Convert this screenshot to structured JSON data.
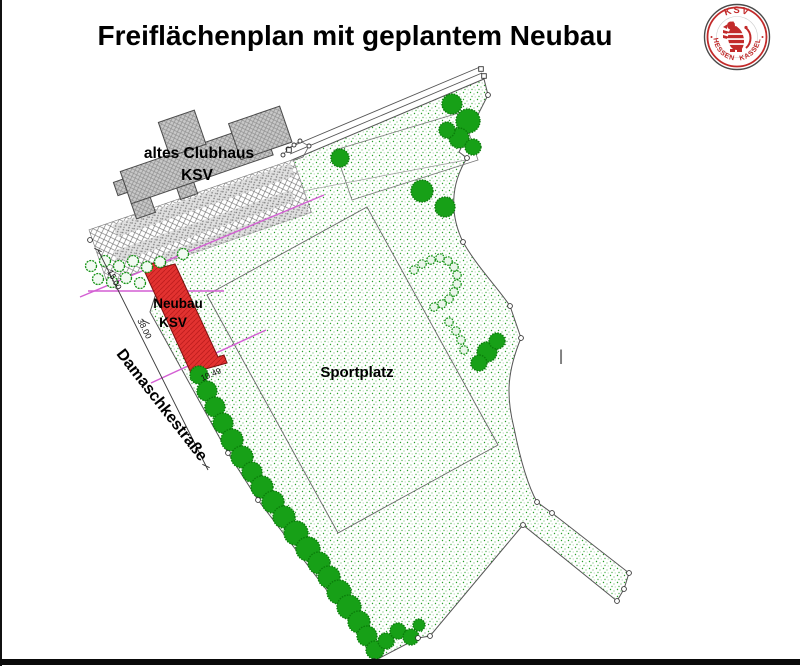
{
  "page": {
    "title": "Freiflächenplan mit geplantem Neubau"
  },
  "logo": {
    "arc_top": "KSV",
    "arc_bottom_left": "HESSEN",
    "arc_bottom_right": "KASSEL",
    "red": "#c22a2a"
  },
  "plan": {
    "buildings": {
      "clubhouse": {
        "line1": "altes Clubhaus",
        "line2": "KSV"
      },
      "neubau": {
        "line1": "Neubau",
        "line2": "KSV"
      }
    },
    "areas": {
      "sportplatz": "Sportplatz"
    },
    "street": {
      "name": "Damaschkestraße"
    },
    "dimensions": [
      "15.00",
      "38.00",
      "10.49"
    ],
    "cursor": "I",
    "colors": {
      "site_stipple_green": "#2aa02a",
      "tree_green": "#17a017",
      "neubau_red": "#e23230",
      "building_gray": "#c8c8c8",
      "dimension_magenta": "#d45fd4",
      "boundary_gray": "#555555"
    }
  }
}
